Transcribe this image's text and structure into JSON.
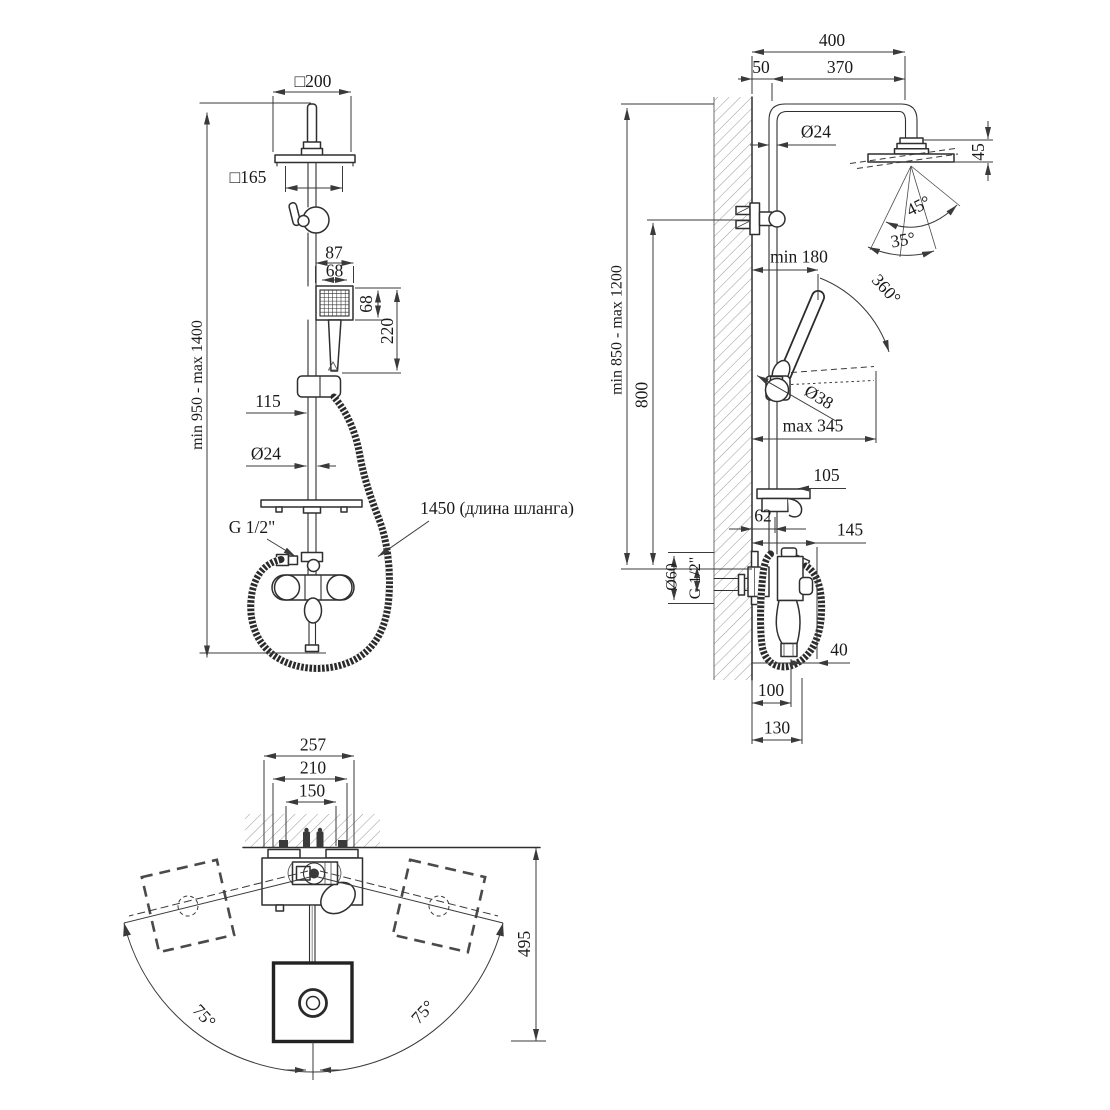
{
  "title": "Shower column technical drawing",
  "colors": {
    "background": "#ffffff",
    "line": "#2f2f2f",
    "dimension": "#3a3a3a",
    "hatch": "#999999"
  },
  "front_view": {
    "labels": {
      "head_size": "□200",
      "mount_size": "□165",
      "handset_outer_width": "87",
      "handset_inner_width": "68",
      "handset_height": "68",
      "handset_length": "220",
      "bracket_offset": "115",
      "pipe_diameter": "Ø24",
      "thread": "G 1/2\"",
      "hose_length": "1450 (длина шланга)",
      "height_range": "min 950 - max 1400"
    }
  },
  "side_view": {
    "labels": {
      "arm_total": "400",
      "wall_offset": "50",
      "arm_reach": "370",
      "pipe_diameter": "Ø24",
      "head_height": "45",
      "tilt_angle": "45°",
      "spray_angle": "35°",
      "handset_offset": "min 180",
      "handset_swivel": "360°",
      "holder_diameter": "Ø38",
      "handset_reach": "max 345",
      "column_height_range": "min 850 - max 1200",
      "bracket_height": "800",
      "shelf_depth": "105",
      "shelf_offset": "62",
      "mixer_reach": "145",
      "escutcheon_diameter": "Ø60",
      "thread": "G 1/2\"",
      "hose_clearance": "40",
      "spout_reach": "100",
      "mixer_depth": "130"
    }
  },
  "plan_view": {
    "labels": {
      "spout_span": "257",
      "mount_span": "210",
      "inlet_spacing": "150",
      "swing_radius": "495",
      "swing_angle_left": "75°",
      "swing_angle_right": "75°"
    }
  }
}
